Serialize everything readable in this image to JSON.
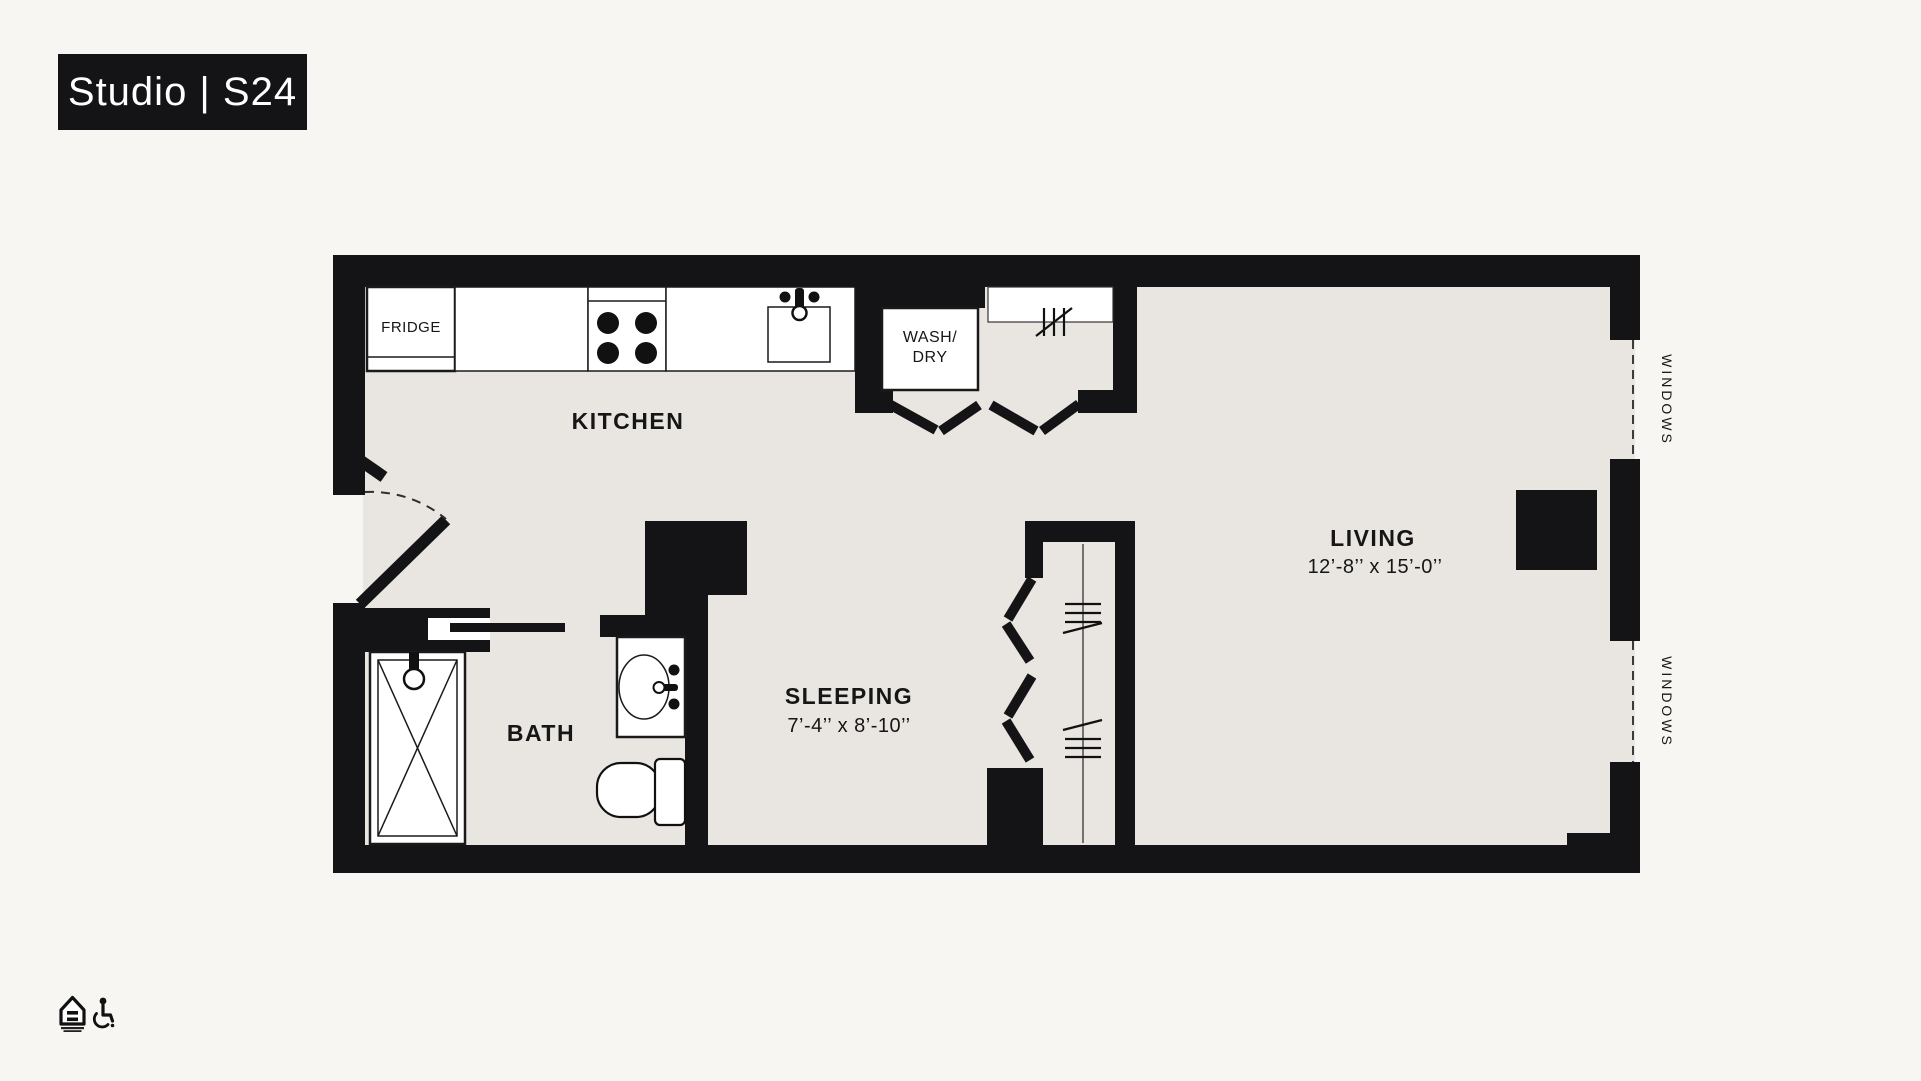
{
  "title": "Studio | S24",
  "plan": {
    "rooms": {
      "kitchen": {
        "label": "KITCHEN"
      },
      "bath": {
        "label": "BATH"
      },
      "sleeping": {
        "label": "SLEEPING",
        "dims": "7’-4’’ x 8’-10’’"
      },
      "living": {
        "label": "LIVING",
        "dims": "12’-8’’ x 15’-0’’"
      }
    },
    "fixtures": {
      "fridge": {
        "label": "FRIDGE"
      },
      "washer_dryer": {
        "line1": "WASH/",
        "line2": "DRY"
      }
    },
    "windows": {
      "label": "WINDOWS"
    },
    "colors": {
      "background": "#f7f6f3",
      "floor": "#e9e6e1",
      "wall": "#141416",
      "fixture": "#ffffff",
      "text": "#161616"
    }
  },
  "footer": {
    "icons": [
      {
        "name": "equal-housing-icon"
      },
      {
        "name": "wheelchair-icon"
      }
    ]
  }
}
